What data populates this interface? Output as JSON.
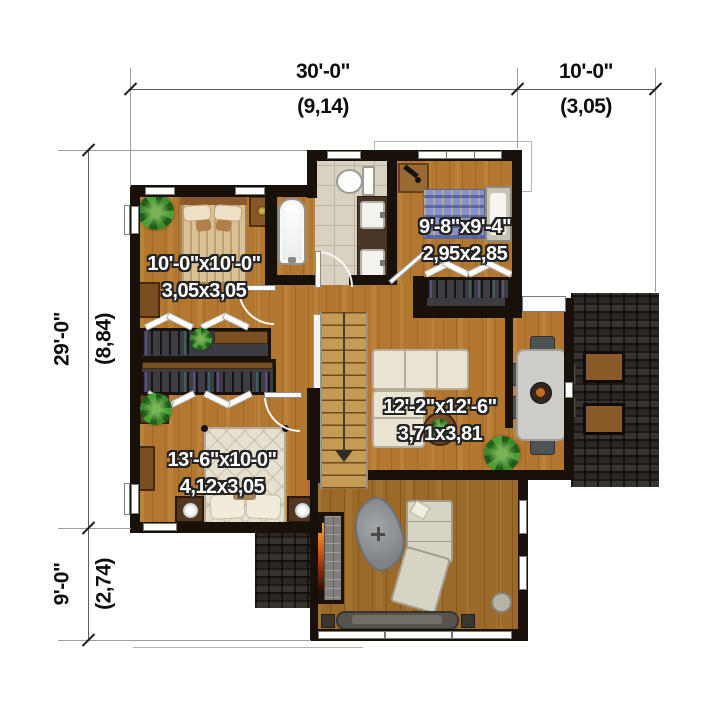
{
  "dimensions": {
    "top": [
      {
        "ft": "30'-0\"",
        "m": "(9,14)"
      },
      {
        "ft": "10'-0\"",
        "m": "(3,05)"
      }
    ],
    "side": [
      {
        "ft": "29'-0\"",
        "m": "(8,84)"
      },
      {
        "ft": "9'-0\"",
        "m": "(2,74)"
      }
    ]
  },
  "rooms": [
    {
      "name": "bedroom-top-left",
      "size_ft": "10'-0\"x10'-0\"",
      "size_m": "3,05x3,05"
    },
    {
      "name": "bedroom-top-right",
      "size_ft": "9'-8\"x9'-4\"",
      "size_m": "2,95x2,85"
    },
    {
      "name": "living-area",
      "size_ft": "12'-2\"x12'-6\"",
      "size_m": "3,71x3,81"
    },
    {
      "name": "bedroom-bottom-left",
      "size_ft": "13'-6\"x10-0\"",
      "size_m": "4,12x3,05"
    }
  ],
  "colors": {
    "floor_wood": "#b3772f",
    "floor_wood_dark": "#9c6a28",
    "wall": "#17110a",
    "roof": "#242120",
    "tile": "#d9d2c3",
    "label_text": "#ffffff",
    "dimension_text": "#0e0e0e"
  }
}
